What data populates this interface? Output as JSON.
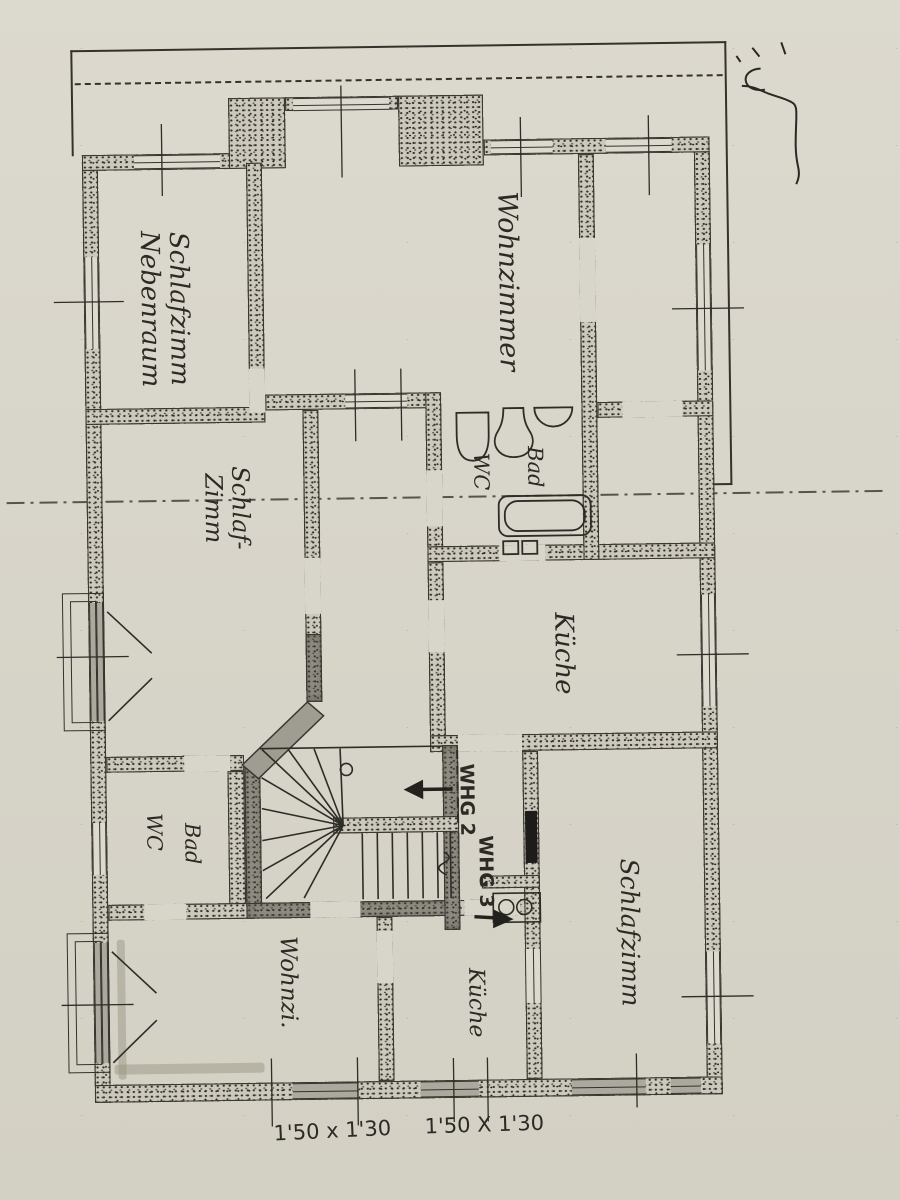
{
  "document": {
    "kind": "scanned hand-drawn floor plan",
    "note": "room names handwritten, rotated 90 degrees"
  },
  "rooms": {
    "bedroom_top_left": {
      "line1": "Schlafzimm",
      "line2": "Nebenraum"
    },
    "living_room_top": {
      "label": "Wohnzimmer"
    },
    "bedroom_mid_left": {
      "line1": "Schlaf-",
      "line2": "Zimm"
    },
    "bath_top": {
      "line1": "Bad",
      "line2": "WC"
    },
    "kitchen_top": {
      "label": "Küche"
    },
    "bath_lower": {
      "line1": "Bad",
      "line2": "WC"
    },
    "living_lower": {
      "label": "Wohnzi."
    },
    "kitchen_lower": {
      "label": "Küche"
    },
    "bedroom_lower_right": {
      "label": "Schlafzimm"
    }
  },
  "annotations": {
    "apartment_2": "WHG 2",
    "apartment_3": "WHG 3"
  },
  "window_dimensions": {
    "left_label": "1'50 x 1'30",
    "right_label": "1'50 X 1'30"
  },
  "colors": {
    "paper": "#d8d5ca",
    "ink": "#2e2c28",
    "wall_stipple": "#3a3832",
    "highlighter_gray": "#9f9c91"
  }
}
